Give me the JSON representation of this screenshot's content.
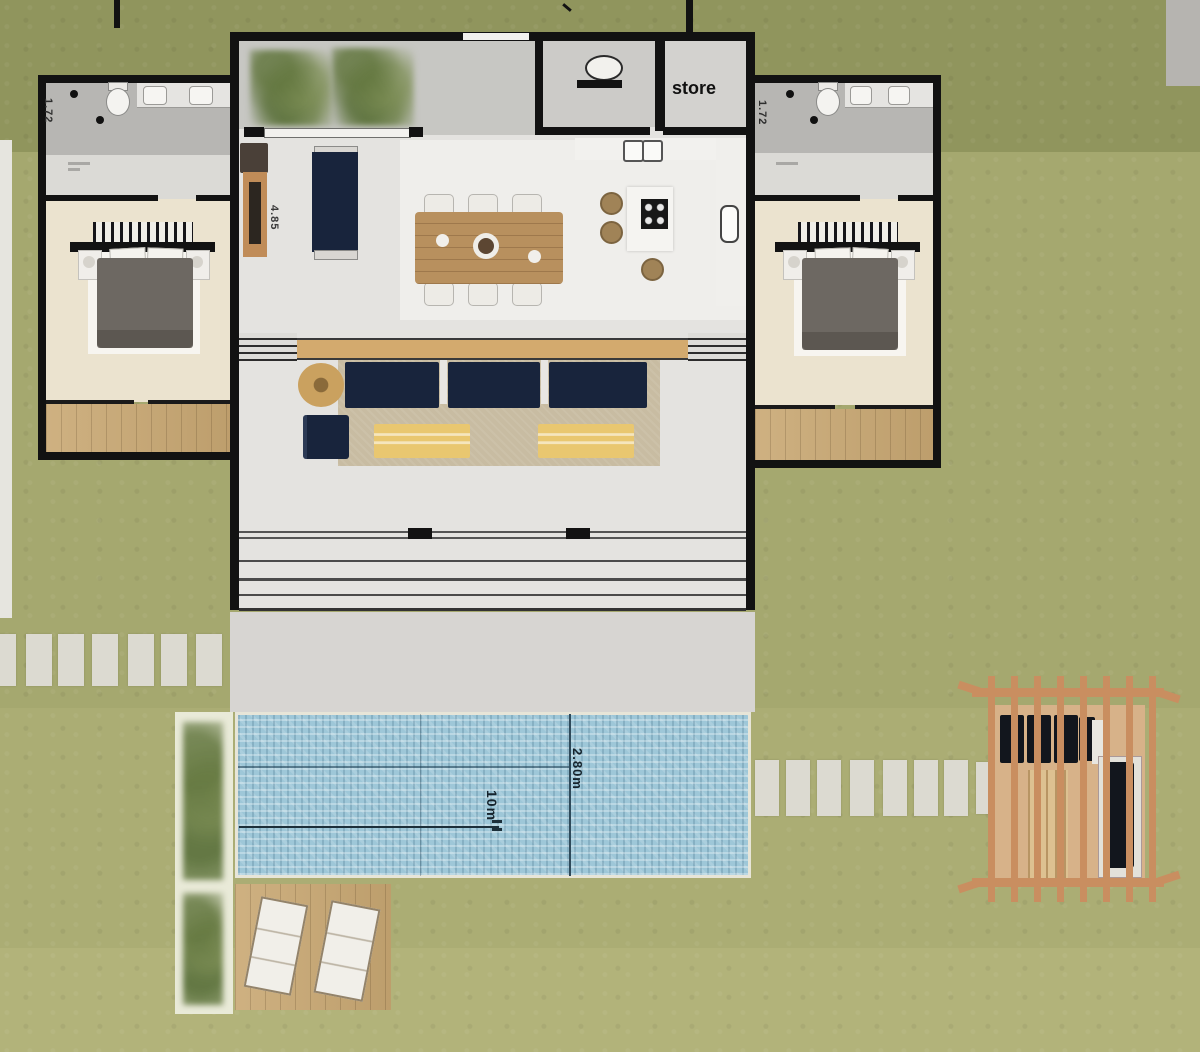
{
  "plan": {
    "labels": {
      "store_room": "store",
      "bath_left_dim": "1.72",
      "bath_right_dim": "1.72",
      "living_dim": "4.85",
      "pool_length": "10m",
      "pool_width": "2.80m"
    },
    "colors": {
      "grass_top": "#90955d",
      "grass_main": "#a5a86f",
      "grass_low": "#abad74",
      "grass_bottom": "#b2b37a",
      "wall": "#121212",
      "floor": "#e4e3e0",
      "floor_light": "#efeeeb",
      "courtyard": "#c7c7c3",
      "bath": "#b7b6b3",
      "vestibule": "#dbdad6",
      "bedroom": "#ebe3cf",
      "deck": "#c9a873",
      "navy": "#18243c",
      "duvet": "#6d6862",
      "rug": "#c8bca2",
      "ottoman": "#e9c770",
      "table_wood": "#b8905e",
      "terrace": "#d7d5d2",
      "pool": "#9ec7d8",
      "planter": "#e9ead8",
      "paver": "#dcdad1",
      "pergola_wood": "#c98e60",
      "cushion_dark": "#12161d",
      "white_trim": "#f2f1ee"
    }
  }
}
